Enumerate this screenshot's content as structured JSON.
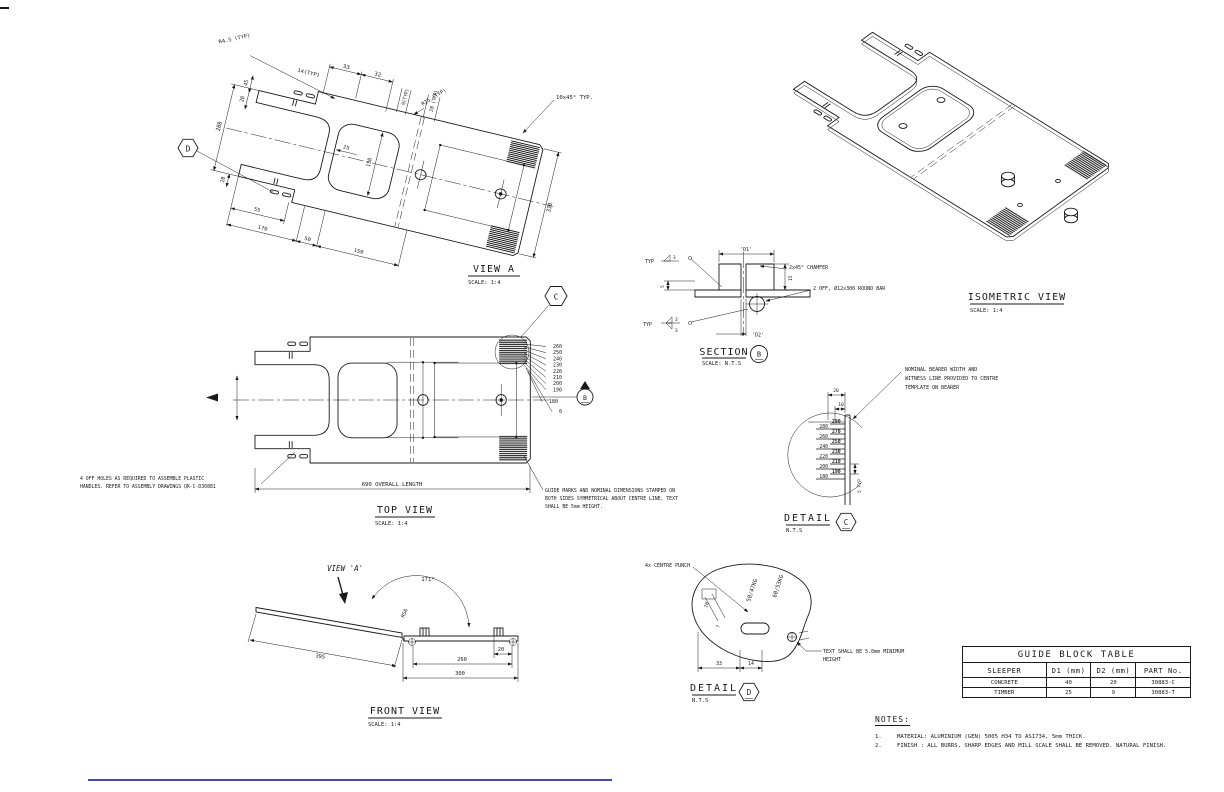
{
  "colors": {
    "line": "#1a1a1a",
    "accent_blue": "#3f48cc"
  },
  "views": {
    "view_a": {
      "title": "VIEW A",
      "scale": "SCALE: 1:4",
      "callout": "D",
      "dims": {
        "r45": "R4.5 (TYP)",
        "typ14": "14(TYP)",
        "d33": "33",
        "d32": "32",
        "typ9": "9(TYP)",
        "typ28": "28 (TYP)",
        "d45": "45",
        "d20a": "20",
        "d208": "208",
        "d25": "25",
        "d150i": "150",
        "d20b": "20",
        "d55": "55",
        "d170": "170",
        "d50": "50",
        "d150": "150",
        "d330": "330",
        "r25": "R25 (TYP)",
        "chamfer": "10x45° TYP."
      }
    },
    "top_view": {
      "title": "TOP VIEW",
      "scale": "SCALE: 1:4",
      "overall": "690 OVERALL LENGTH",
      "callout": "C",
      "section": "B",
      "stack": [
        "260",
        "250",
        "240",
        "230",
        "220",
        "210",
        "200",
        "190",
        "180",
        "0"
      ],
      "note_left": [
        "4 OFF HOLES AS REQUIRED TO ASSEMBLE PLASTIC",
        "HANDLES. REFER TO ASSEMBLY DRAWINGS QR-C-D30881"
      ],
      "note_right": [
        "GUIDE MARKS AND NOMINAL DIMENSIONS STAMPED ON",
        "BOTH SIDES SYMMETRICAL ABOUT  CENTRE LINE, TEXT",
        "SHALL BE 5mm HEIGHT."
      ]
    },
    "front_view": {
      "title": "FRONT VIEW",
      "scale": "SCALE: 1:4",
      "view_label": "VIEW 'A'",
      "angle": "171°",
      "r50": "R50",
      "d395": "395",
      "d20": "20",
      "d260": "260",
      "d300": "300"
    },
    "isometric": {
      "title": "ISOMETRIC VIEW",
      "scale": "SCALE: 1:4"
    },
    "section_b": {
      "title": "SECTION",
      "scale": "SCALE: N.T.S",
      "bubble": "B",
      "d1": "'D1'",
      "d2": "'D2'",
      "chamfer": "2x45° CHAMFER",
      "round_bar": "2 OFF, Ø12x300 ROUND BAR",
      "d5": "5",
      "d15": "15",
      "typ_top": "TYP",
      "w3_top": "3",
      "typ_bot": "TYP",
      "w3a": "3",
      "w3b": "3"
    },
    "detail_c": {
      "title": "DETAIL",
      "scale": "N.T.S",
      "bubble": "C",
      "d20": "20",
      "d10": "10",
      "typ5": "5 TYP",
      "note": [
        "NOMINAL BEARER WIDTH AND",
        "WITNESS LINE PROVIDED TO CENTRE",
        "TEMPLATE ON BEARER"
      ],
      "stack_left": [
        "280",
        "260",
        "240",
        "220",
        "200",
        "180"
      ],
      "stack_right": [
        "290",
        "270",
        "250",
        "230",
        "210",
        "190"
      ]
    },
    "detail_d": {
      "title": "DETAIL",
      "scale": "N.T.S",
      "bubble": "D",
      "punch": "4x CENTRE PUNCH",
      "kg1": "50/47KG",
      "kg2": "60/53KG",
      "note": [
        "TEXT SHALL BE 5.0mm MINIMUM",
        "HEIGHT"
      ],
      "d10": "10",
      "d7": "7",
      "d33": "33",
      "d14": "14"
    }
  },
  "table": {
    "title": "GUIDE BLOCK TABLE",
    "headers": [
      "SLEEPER",
      "D1 (mm)",
      "D2 (mm)",
      "PART No."
    ],
    "rows": [
      [
        "CONCRETE",
        "40",
        "20",
        "30883-C"
      ],
      [
        "TIMBER",
        "25",
        "9",
        "30883-T"
      ]
    ]
  },
  "notes": {
    "title": "NOTES:",
    "items": [
      {
        "num": "1.",
        "text": "MATERIAL: ALUMINIUM (GEN) 5005 H34 TO AS1734,  5mm THICK."
      },
      {
        "num": "2.",
        "text": "FINISH : ALL BURRS, SHARP EDGES AND MILL SCALE SHALL BE REMOVED. NATURAL FINISH."
      }
    ]
  }
}
